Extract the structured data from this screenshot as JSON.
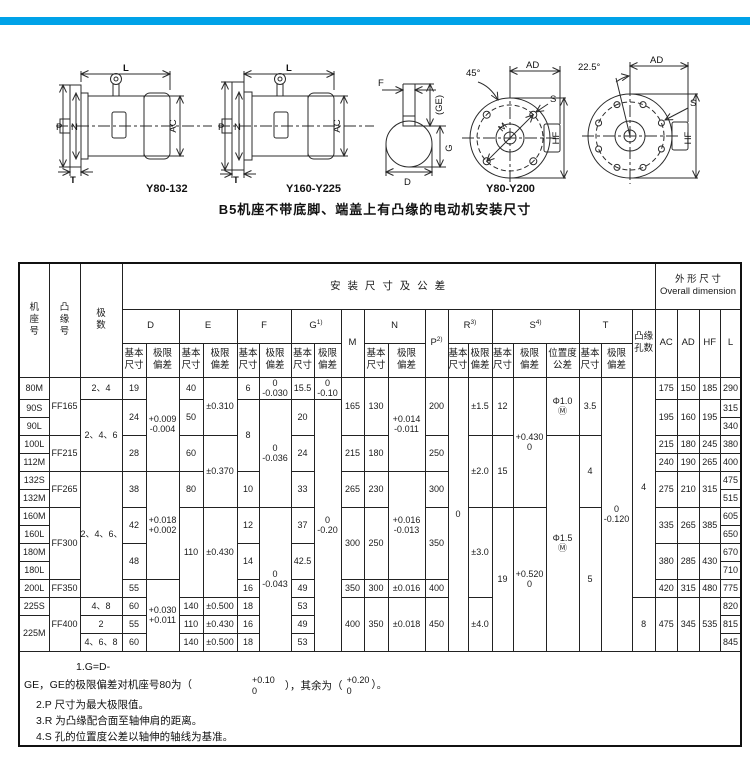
{
  "accent_color": "#00a2e8",
  "figures": {
    "caption": "B5机座不带底脚、端盖上有凸缘的电动机安装尺寸",
    "labels": {
      "fig1": "Y80-132",
      "fig2": "Y160-Y225",
      "fig3": "Y80-Y200"
    },
    "dims": {
      "L": "L",
      "P": "P",
      "N": "N",
      "AC": "AC",
      "T": "T",
      "F": "F",
      "GE": "(GE)",
      "G": "G",
      "D": "D",
      "AD": "AD",
      "HF": "HF",
      "S": "S",
      "M": "M",
      "angle45": "45°",
      "angle225": "22.5°"
    }
  },
  "table": {
    "header_rows": [
      [
        {
          "t": "机\n座\n号",
          "rs": 3
        },
        {
          "t": "凸\n缘\n号",
          "rs": 3
        },
        {
          "t": "极\n数",
          "rs": 3
        },
        {
          "t": "安 装 尺 寸 及 公 差",
          "cs": 20,
          "cls": "install"
        },
        {
          "t": "外 形 尺 寸\nOverall dimension",
          "cs": 4
        }
      ],
      [
        {
          "t": "D",
          "cs": 2
        },
        {
          "t": "E",
          "cs": 2
        },
        {
          "t": "F",
          "cs": 2
        },
        {
          "t": "G",
          "sup": "1)",
          "cs": 2
        },
        {
          "t": "M",
          "rs": 2
        },
        {
          "t": "N",
          "cs": 2
        },
        {
          "t": "P",
          "sup": "2)",
          "rs": 2
        },
        {
          "t": "R",
          "sup": "3)",
          "cs": 2
        },
        {
          "t": "S",
          "sup": "4)",
          "cs": 3
        },
        {
          "t": "T",
          "cs": 2
        },
        {
          "t": "凸缘\n孔数",
          "rs": 2
        },
        {
          "t": "AC",
          "rs": 2
        },
        {
          "t": "AD",
          "rs": 2
        },
        {
          "t": "HF",
          "rs": 2
        },
        {
          "t": "L",
          "rs": 2
        }
      ],
      [
        {
          "t": "基本\n尺寸"
        },
        {
          "t": "极限\n偏差"
        },
        {
          "t": "基本\n尺寸"
        },
        {
          "t": "极限\n偏差"
        },
        {
          "t": "基本\n尺寸"
        },
        {
          "t": "极限\n偏差"
        },
        {
          "t": "基本\n尺寸"
        },
        {
          "t": "极限\n偏差"
        },
        {
          "t": "基本\n尺寸"
        },
        {
          "t": "极限\n偏差"
        },
        {
          "t": "基本\n尺寸"
        },
        {
          "t": "极限\n偏差"
        },
        {
          "t": "基本\n尺寸"
        },
        {
          "t": "极限\n偏差"
        },
        {
          "t": "位置度\n公差"
        },
        {
          "t": "基本\n尺寸"
        },
        {
          "t": "极限\n偏差"
        }
      ]
    ],
    "body_rows": [
      [
        {
          "t": "80M"
        },
        {
          "t": "FF165",
          "rs": 3
        },
        {
          "t": "2、4"
        },
        {
          "t": "19"
        },
        {
          "t": "+0.009\n-0.004",
          "rs": 5
        },
        {
          "t": "40"
        },
        {
          "t": "±0.310",
          "rs": 3
        },
        {
          "t": "6"
        },
        {
          "t": "0\n-0.030"
        },
        {
          "t": "15.5"
        },
        {
          "t": "0\n-0.10"
        },
        {
          "t": "165",
          "rs": 3
        },
        {
          "t": "130",
          "rs": 3
        },
        {
          "t": "+0.014\n-0.011",
          "rs": 5
        },
        {
          "t": "200",
          "rs": 3
        },
        {
          "t": "0",
          "rs": 15
        },
        {
          "t": "±1.5",
          "rs": 3
        },
        {
          "t": "12",
          "rs": 3
        },
        {
          "t": "+0.430\n0",
          "rs": 7
        },
        {
          "t": "Φ1.0\nⓂ",
          "rs": 3
        },
        {
          "t": "3.5",
          "rs": 3
        },
        {
          "t": "0\n-0.120",
          "rs": 15
        },
        {
          "t": "4",
          "rs": 12
        },
        {
          "t": "175"
        },
        {
          "t": "150"
        },
        {
          "t": "185"
        },
        {
          "t": "290"
        }
      ],
      [
        {
          "t": "90S"
        },
        {
          "t": "2、4、6",
          "rs": 4
        },
        {
          "t": "24",
          "rs": 2
        },
        {
          "t": "50",
          "rs": 2
        },
        {
          "t": "8",
          "rs": 4
        },
        {
          "t": "0\n-0.036",
          "rs": 6
        },
        {
          "t": "20",
          "rs": 2
        },
        {
          "t": "0\n-0.20",
          "rs": 14
        },
        {
          "t": "195",
          "rs": 2
        },
        {
          "t": "160",
          "rs": 2
        },
        {
          "t": "195",
          "rs": 2
        },
        {
          "t": "315"
        }
      ],
      [
        {
          "t": "90L"
        },
        {
          "t": "340"
        }
      ],
      [
        {
          "t": "100L"
        },
        {
          "t": "FF215",
          "rs": 2
        },
        {
          "t": "28",
          "rs": 2
        },
        {
          "t": "60",
          "rs": 2
        },
        {
          "t": "±0.370",
          "rs": 4
        },
        {
          "t": "24",
          "rs": 2
        },
        {
          "t": "215",
          "rs": 2
        },
        {
          "t": "180",
          "rs": 2
        },
        {
          "t": "250",
          "rs": 2
        },
        {
          "t": "±2.0",
          "rs": 4
        },
        {
          "t": "15",
          "rs": 4
        },
        {
          "t": "Φ1.5\nⓂ",
          "rs": 12
        },
        {
          "t": "4",
          "rs": 4
        },
        {
          "t": "215"
        },
        {
          "t": "180"
        },
        {
          "t": "245"
        },
        {
          "t": "380"
        }
      ],
      [
        {
          "t": "112M"
        },
        {
          "t": "240"
        },
        {
          "t": "190"
        },
        {
          "t": "265"
        },
        {
          "t": "400"
        }
      ],
      [
        {
          "t": "132S"
        },
        {
          "t": "FF265",
          "rs": 2
        },
        {
          "t": "2、4、6、8",
          "rs": 7
        },
        {
          "t": "38",
          "rs": 2
        },
        {
          "t": "+0.018\n+0.002",
          "rs": 6
        },
        {
          "t": "80",
          "rs": 2
        },
        {
          "t": "10",
          "rs": 2
        },
        {
          "t": "33",
          "rs": 2
        },
        {
          "t": "265",
          "rs": 2
        },
        {
          "t": "230",
          "rs": 2
        },
        {
          "t": "+0.016\n-0.013",
          "rs": 6
        },
        {
          "t": "300",
          "rs": 2
        },
        {
          "t": "275",
          "rs": 2
        },
        {
          "t": "210",
          "rs": 2
        },
        {
          "t": "315",
          "rs": 2
        },
        {
          "t": "475"
        }
      ],
      [
        {
          "t": "132M"
        },
        {
          "t": "515"
        }
      ],
      [
        {
          "t": "160M"
        },
        {
          "t": "FF300",
          "rs": 4
        },
        {
          "t": "42",
          "rs": 2
        },
        {
          "t": "110",
          "rs": 5
        },
        {
          "t": "±0.430",
          "rs": 5
        },
        {
          "t": "12",
          "rs": 2
        },
        {
          "t": "0\n-0.043",
          "rs": 8
        },
        {
          "t": "37",
          "rs": 2
        },
        {
          "t": "300",
          "rs": 4
        },
        {
          "t": "250",
          "rs": 4
        },
        {
          "t": "350",
          "rs": 4
        },
        {
          "t": "±3.0",
          "rs": 5
        },
        {
          "t": "19",
          "rs": 8
        },
        {
          "t": "+0.520\n0",
          "rs": 8
        },
        {
          "t": "5",
          "rs": 8
        },
        {
          "t": "335",
          "rs": 2
        },
        {
          "t": "265",
          "rs": 2
        },
        {
          "t": "385",
          "rs": 2
        },
        {
          "t": "605"
        }
      ],
      [
        {
          "t": "160L"
        },
        {
          "t": "650"
        }
      ],
      [
        {
          "t": "180M"
        },
        {
          "t": "48",
          "rs": 2
        },
        {
          "t": "14",
          "rs": 2
        },
        {
          "t": "42.5",
          "rs": 2
        },
        {
          "t": "380",
          "rs": 2
        },
        {
          "t": "285",
          "rs": 2
        },
        {
          "t": "430",
          "rs": 2
        },
        {
          "t": "670"
        }
      ],
      [
        {
          "t": "180L"
        },
        {
          "t": "710"
        }
      ],
      [
        {
          "t": "200L"
        },
        {
          "t": "FF350"
        },
        {
          "t": "55"
        },
        {
          "t": "+0.030\n+0.011",
          "rs": 4
        },
        {
          "t": "16"
        },
        {
          "t": "49"
        },
        {
          "t": "350"
        },
        {
          "t": "300"
        },
        {
          "t": "±0.016"
        },
        {
          "t": "400"
        },
        {
          "t": "420"
        },
        {
          "t": "315"
        },
        {
          "t": "480"
        },
        {
          "t": "775"
        }
      ],
      [
        {
          "t": "225S"
        },
        {
          "t": "FF400",
          "rs": 3
        },
        {
          "t": "4、8"
        },
        {
          "t": "60"
        },
        {
          "t": "140"
        },
        {
          "t": "±0.500"
        },
        {
          "t": "18"
        },
        {
          "t": "53"
        },
        {
          "t": "400",
          "rs": 3
        },
        {
          "t": "350",
          "rs": 3
        },
        {
          "t": "±0.018",
          "rs": 3
        },
        {
          "t": "450",
          "rs": 3
        },
        {
          "t": "±4.0",
          "rs": 3
        },
        {
          "t": "8",
          "rs": 3
        },
        {
          "t": "475",
          "rs": 3
        },
        {
          "t": "345",
          "rs": 3
        },
        {
          "t": "535",
          "rs": 3
        },
        {
          "t": "820"
        }
      ],
      [
        {
          "t": "225M",
          "rs": 2
        },
        {
          "t": "2"
        },
        {
          "t": "55"
        },
        {
          "t": "110"
        },
        {
          "t": "±0.430"
        },
        {
          "t": "16"
        },
        {
          "t": "49"
        },
        {
          "t": "815"
        }
      ],
      [
        {
          "t": "4、6、8"
        },
        {
          "t": "60"
        },
        {
          "t": "140"
        },
        {
          "t": "±0.500"
        },
        {
          "t": "18"
        },
        {
          "t": "53"
        },
        {
          "t": "845"
        }
      ]
    ]
  },
  "notes": {
    "n1a": "1.G=D-",
    "n1b": "GE，GE的极限偏差对机座号80为（",
    "f1_top": "+0.10",
    "f1_bot": "0",
    "n1c": "），其余为（",
    "f2_top": "+0.20",
    "f2_bot": "0",
    "n1d": "）。",
    "n2": "2.P 尺寸为最大极限值。",
    "n3": "3.R 为凸缘配合面至轴伸肩的距离。",
    "n4": "4.S 孔的位置度公差以轴伸的轴线为基准。"
  }
}
